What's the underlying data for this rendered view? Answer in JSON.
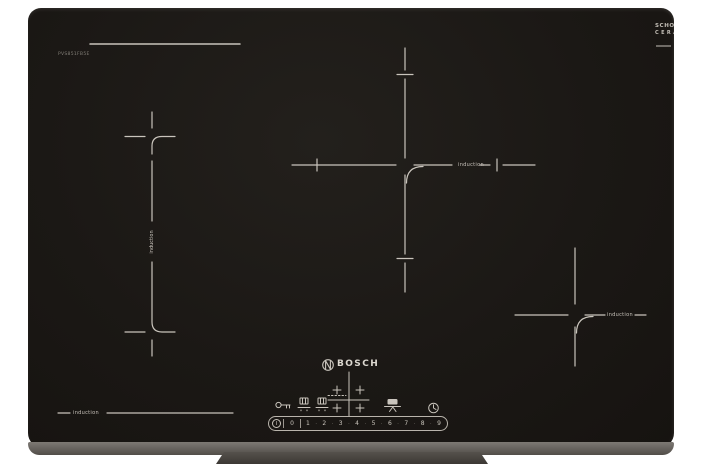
{
  "branding": {
    "manufacturer": "BOSCH",
    "glass_brand": {
      "line1": "SCHOTT",
      "line2": "CERAN"
    },
    "model_number": "PVS851FB5E"
  },
  "zone_labels": {
    "flex_left_vertical": "induction",
    "center_rear": "induction",
    "right_front": "induction",
    "front_left": "induction"
  },
  "controls": {
    "power_symbol": "I",
    "number_separator": "·",
    "slider_numbers": [
      "0",
      "1",
      "2",
      "3",
      "4",
      "5",
      "6",
      "7",
      "8",
      "9"
    ],
    "icon_names": [
      "key-lock-icon",
      "pan-zone-left-icon",
      "pan-zone-right-icon",
      "pot-stand-icon",
      "timer-clock-icon",
      "power-icon",
      "bosch-emblem-icon",
      "zone-map-icon"
    ]
  },
  "colors": {
    "glass": "#1b1815",
    "marking_line": "#c9c4bc",
    "bevel": "#6e6a65",
    "stand": "#46423e"
  }
}
